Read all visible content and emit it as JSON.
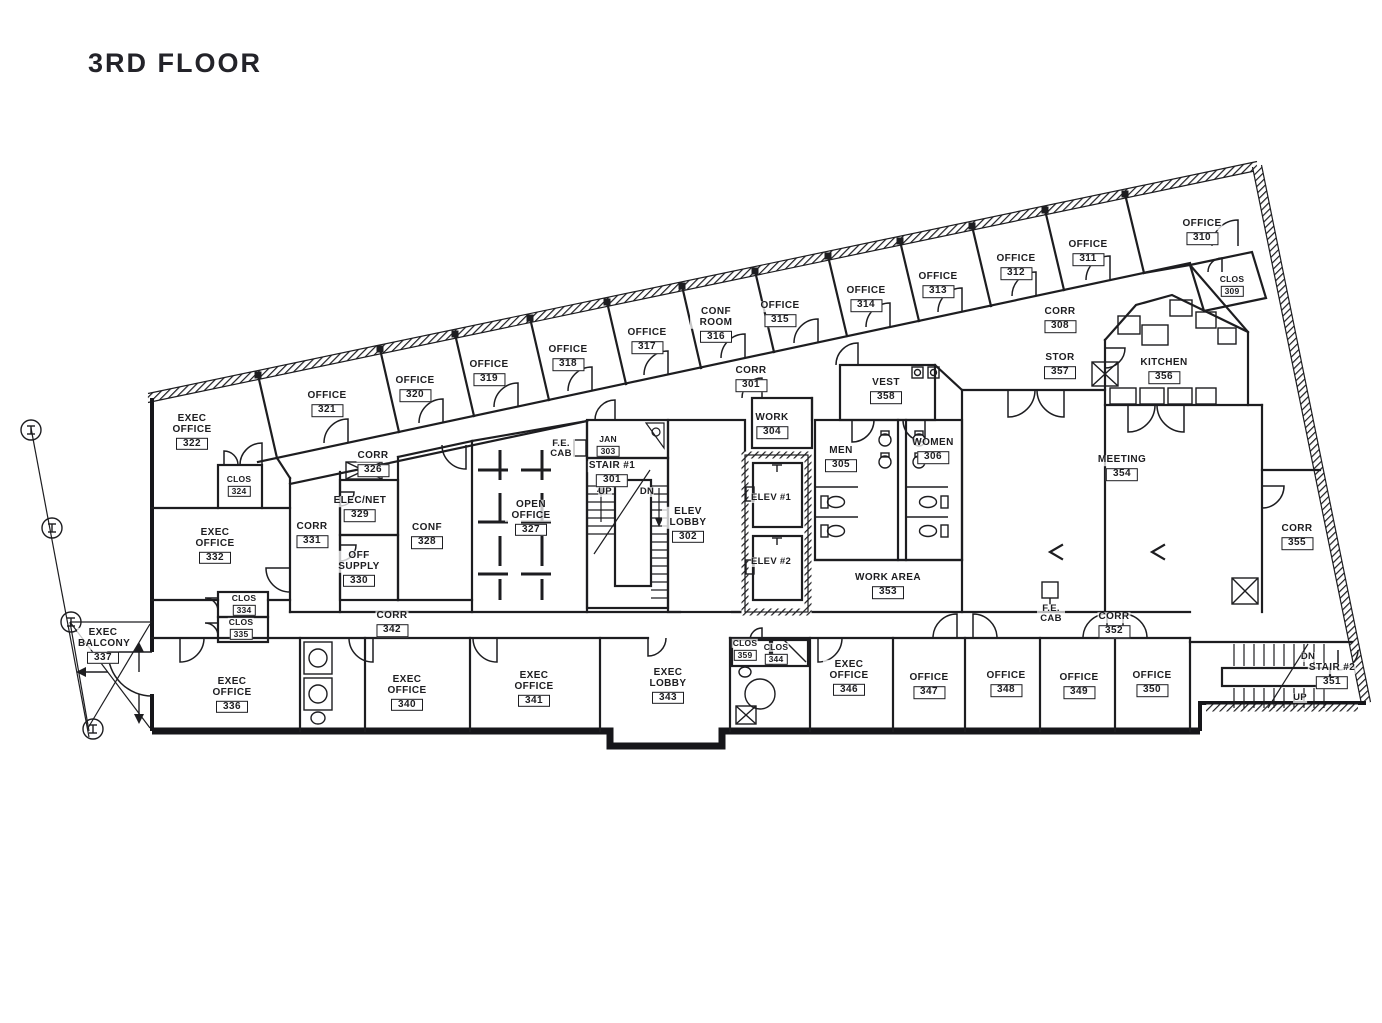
{
  "title": "3RD FLOOR",
  "colors": {
    "ink": "#1d1d20",
    "background": "#ffffff"
  },
  "rooms": [
    {
      "name": "OFFICE",
      "number": "310"
    },
    {
      "name": "CLOS",
      "number": "309"
    },
    {
      "name": "OFFICE",
      "number": "311"
    },
    {
      "name": "OFFICE",
      "number": "312"
    },
    {
      "name": "OFFICE",
      "number": "313"
    },
    {
      "name": "OFFICE",
      "number": "314"
    },
    {
      "name": "OFFICE",
      "number": "315"
    },
    {
      "name": "CONF ROOM",
      "number": "316"
    },
    {
      "name": "OFFICE",
      "number": "317"
    },
    {
      "name": "OFFICE",
      "number": "318"
    },
    {
      "name": "OFFICE",
      "number": "319"
    },
    {
      "name": "OFFICE",
      "number": "320"
    },
    {
      "name": "OFFICE",
      "number": "321"
    },
    {
      "name": "EXEC OFFICE",
      "number": "322"
    },
    {
      "name": "CLOS",
      "number": "324"
    },
    {
      "name": "CORR",
      "number": "326"
    },
    {
      "name": "ELEC/NET",
      "number": "329"
    },
    {
      "name": "CORR",
      "number": "331"
    },
    {
      "name": "OFF SUPPLY",
      "number": "330"
    },
    {
      "name": "EXEC OFFICE",
      "number": "332"
    },
    {
      "name": "CONF",
      "number": "328"
    },
    {
      "name": "OPEN OFFICE",
      "number": "327"
    },
    {
      "name": "JAN",
      "number": "303"
    },
    {
      "name": "STAIR #1",
      "number": "301"
    },
    {
      "name": "CORR",
      "number": "301"
    },
    {
      "name": "WORK",
      "number": "304"
    },
    {
      "name": "VEST",
      "number": "358"
    },
    {
      "name": "MEN",
      "number": "305"
    },
    {
      "name": "WOMEN",
      "number": "306"
    },
    {
      "name": "ELEV LOBBY",
      "number": "302"
    },
    {
      "name": "WORK AREA",
      "number": "353"
    },
    {
      "name": "CORR",
      "number": "308"
    },
    {
      "name": "STOR",
      "number": "357"
    },
    {
      "name": "KITCHEN",
      "number": "356"
    },
    {
      "name": "MEETING",
      "number": "354"
    },
    {
      "name": "CORR",
      "number": "355"
    },
    {
      "name": "CORR",
      "number": "352"
    },
    {
      "name": "STAIR #2",
      "number": "351"
    },
    {
      "name": "OFFICE",
      "number": "350"
    },
    {
      "name": "OFFICE",
      "number": "349"
    },
    {
      "name": "OFFICE",
      "number": "348"
    },
    {
      "name": "OFFICE",
      "number": "347"
    },
    {
      "name": "EXEC OFFICE",
      "number": "346"
    },
    {
      "name": "CLOS",
      "number": "359"
    },
    {
      "name": "CLOS",
      "number": "344"
    },
    {
      "name": "EXEC LOBBY",
      "number": "343"
    },
    {
      "name": "EXEC OFFICE",
      "number": "341"
    },
    {
      "name": "EXEC OFFICE",
      "number": "340"
    },
    {
      "name": "CORR",
      "number": "342"
    },
    {
      "name": "CLOS",
      "number": "334"
    },
    {
      "name": "CLOS",
      "number": "335"
    },
    {
      "name": "EXEC OFFICE",
      "number": "336"
    },
    {
      "name": "EXEC BALCONY",
      "number": "337"
    }
  ],
  "annotations": {
    "fe_cab": "F.E. CAB",
    "up": "UP",
    "dn": "DN",
    "elev_1": "ELEV #1",
    "elev_2": "ELEV #2"
  }
}
